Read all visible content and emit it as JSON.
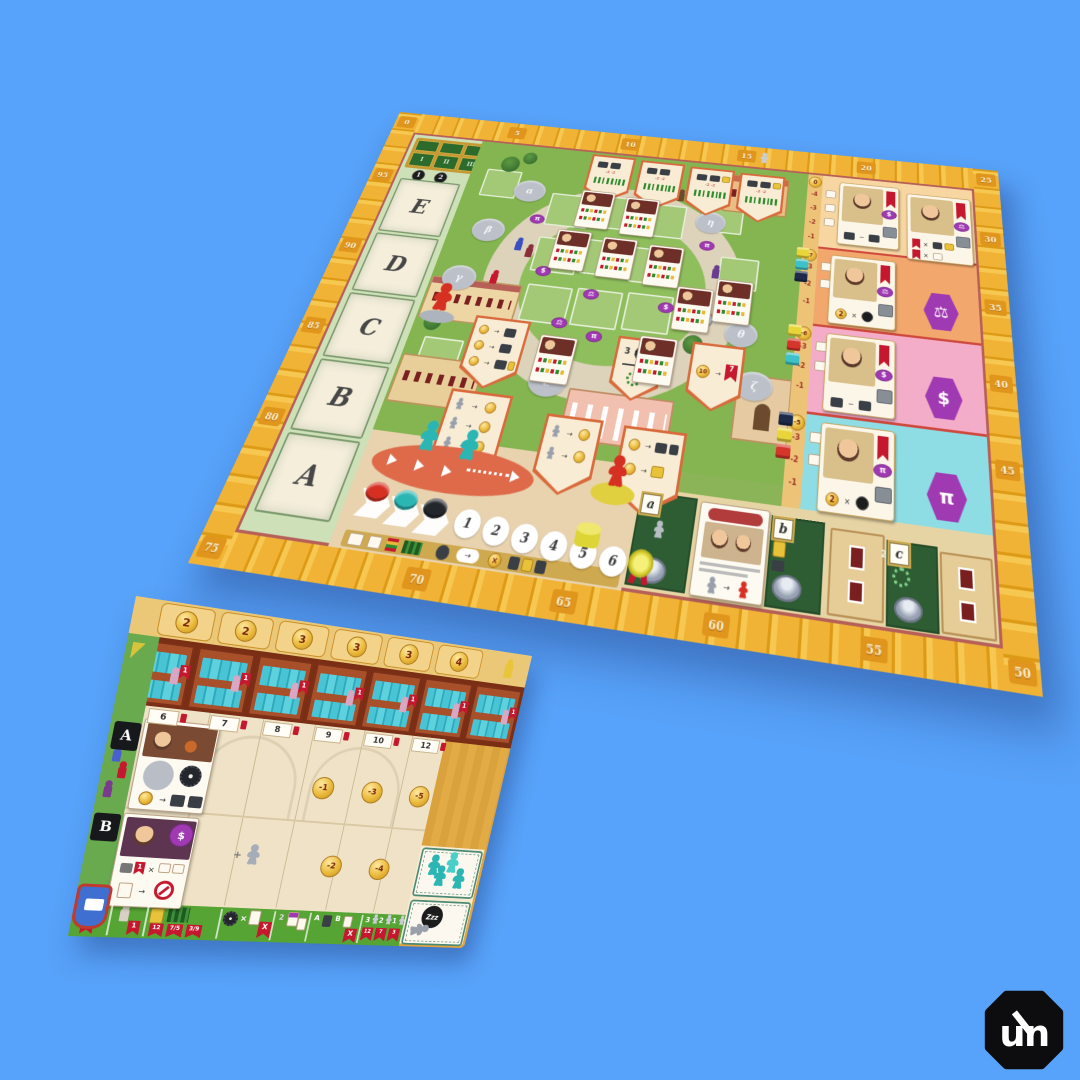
{
  "scene": {
    "background_color": "#57a2fa",
    "description": "Alma Mater board game main board and player board on blue background"
  },
  "logo": {
    "monogram": "un"
  },
  "icons": {
    "multiply": "×",
    "minus": "−",
    "plus": "+",
    "arrow": "→"
  },
  "main_board": {
    "score_track": {
      "top": [
        "0",
        "5",
        "10",
        "15",
        "20",
        "25"
      ],
      "right": [
        "30",
        "35",
        "40",
        "45",
        "50"
      ],
      "bottom": [
        "55",
        "60",
        "65",
        "70"
      ],
      "left": [
        "75",
        "80",
        "85",
        "90",
        "95"
      ]
    },
    "letter_spaces": [
      "E",
      "D",
      "C",
      "B",
      "A"
    ],
    "study_table": {
      "columns": [
        "I",
        "II",
        "III"
      ],
      "tokens": [
        "1",
        "2"
      ]
    },
    "banner_penalty": "-2 -2",
    "greek_spots": [
      "α",
      "β",
      "γ",
      "ε",
      "ζ",
      "η",
      "θ"
    ],
    "faculty_badges": {
      "law": "⚖",
      "economics": "$",
      "mathematics": "π"
    },
    "faculty_rows": [
      {
        "coin": "0"
      },
      {
        "coin": "-7",
        "symbol": "⚖"
      },
      {
        "coin": "-6",
        "symbol": "$"
      },
      {
        "coin": "-5",
        "symbol": "π"
      }
    ],
    "penalty_steps": [
      "-1",
      "-2",
      "-3",
      "-4"
    ],
    "gear_count": "3",
    "card_multiplier": "2",
    "pavilion_flag": {
      "coin": "10",
      "flag": "7"
    },
    "garden_labels": [
      "a",
      "b",
      "c"
    ],
    "garden_counts": {
      "b_cards": "2",
      "c_wreath": "2"
    },
    "round_track": [
      "1",
      "2",
      "3",
      "4",
      "5",
      "6"
    ]
  },
  "player_board": {
    "shelf_coins": [
      "2",
      "2",
      "3",
      "3",
      "3",
      "4"
    ],
    "shelf_flag": "1",
    "row_tabs": [
      "A",
      "B"
    ],
    "column_labels": [
      "6",
      "7",
      "8",
      "9",
      "10",
      "12"
    ],
    "penalty_coins_top": [
      "-1",
      "-3",
      "-5"
    ],
    "penalty_coins_bottom": [
      "-2",
      "-4"
    ],
    "rest_label": "Zzz",
    "scoring_strip": {
      "turn_flag": "1",
      "student_flag": "1",
      "book_flags": [
        "12",
        "7/5",
        "3/9"
      ],
      "multiplier_flag": "X",
      "pair_count": "2",
      "ab_labels": [
        "A",
        "B"
      ],
      "meeple_counts": [
        "3",
        "2",
        "1"
      ],
      "meeple_flags": [
        "12",
        "7",
        "3"
      ]
    }
  }
}
